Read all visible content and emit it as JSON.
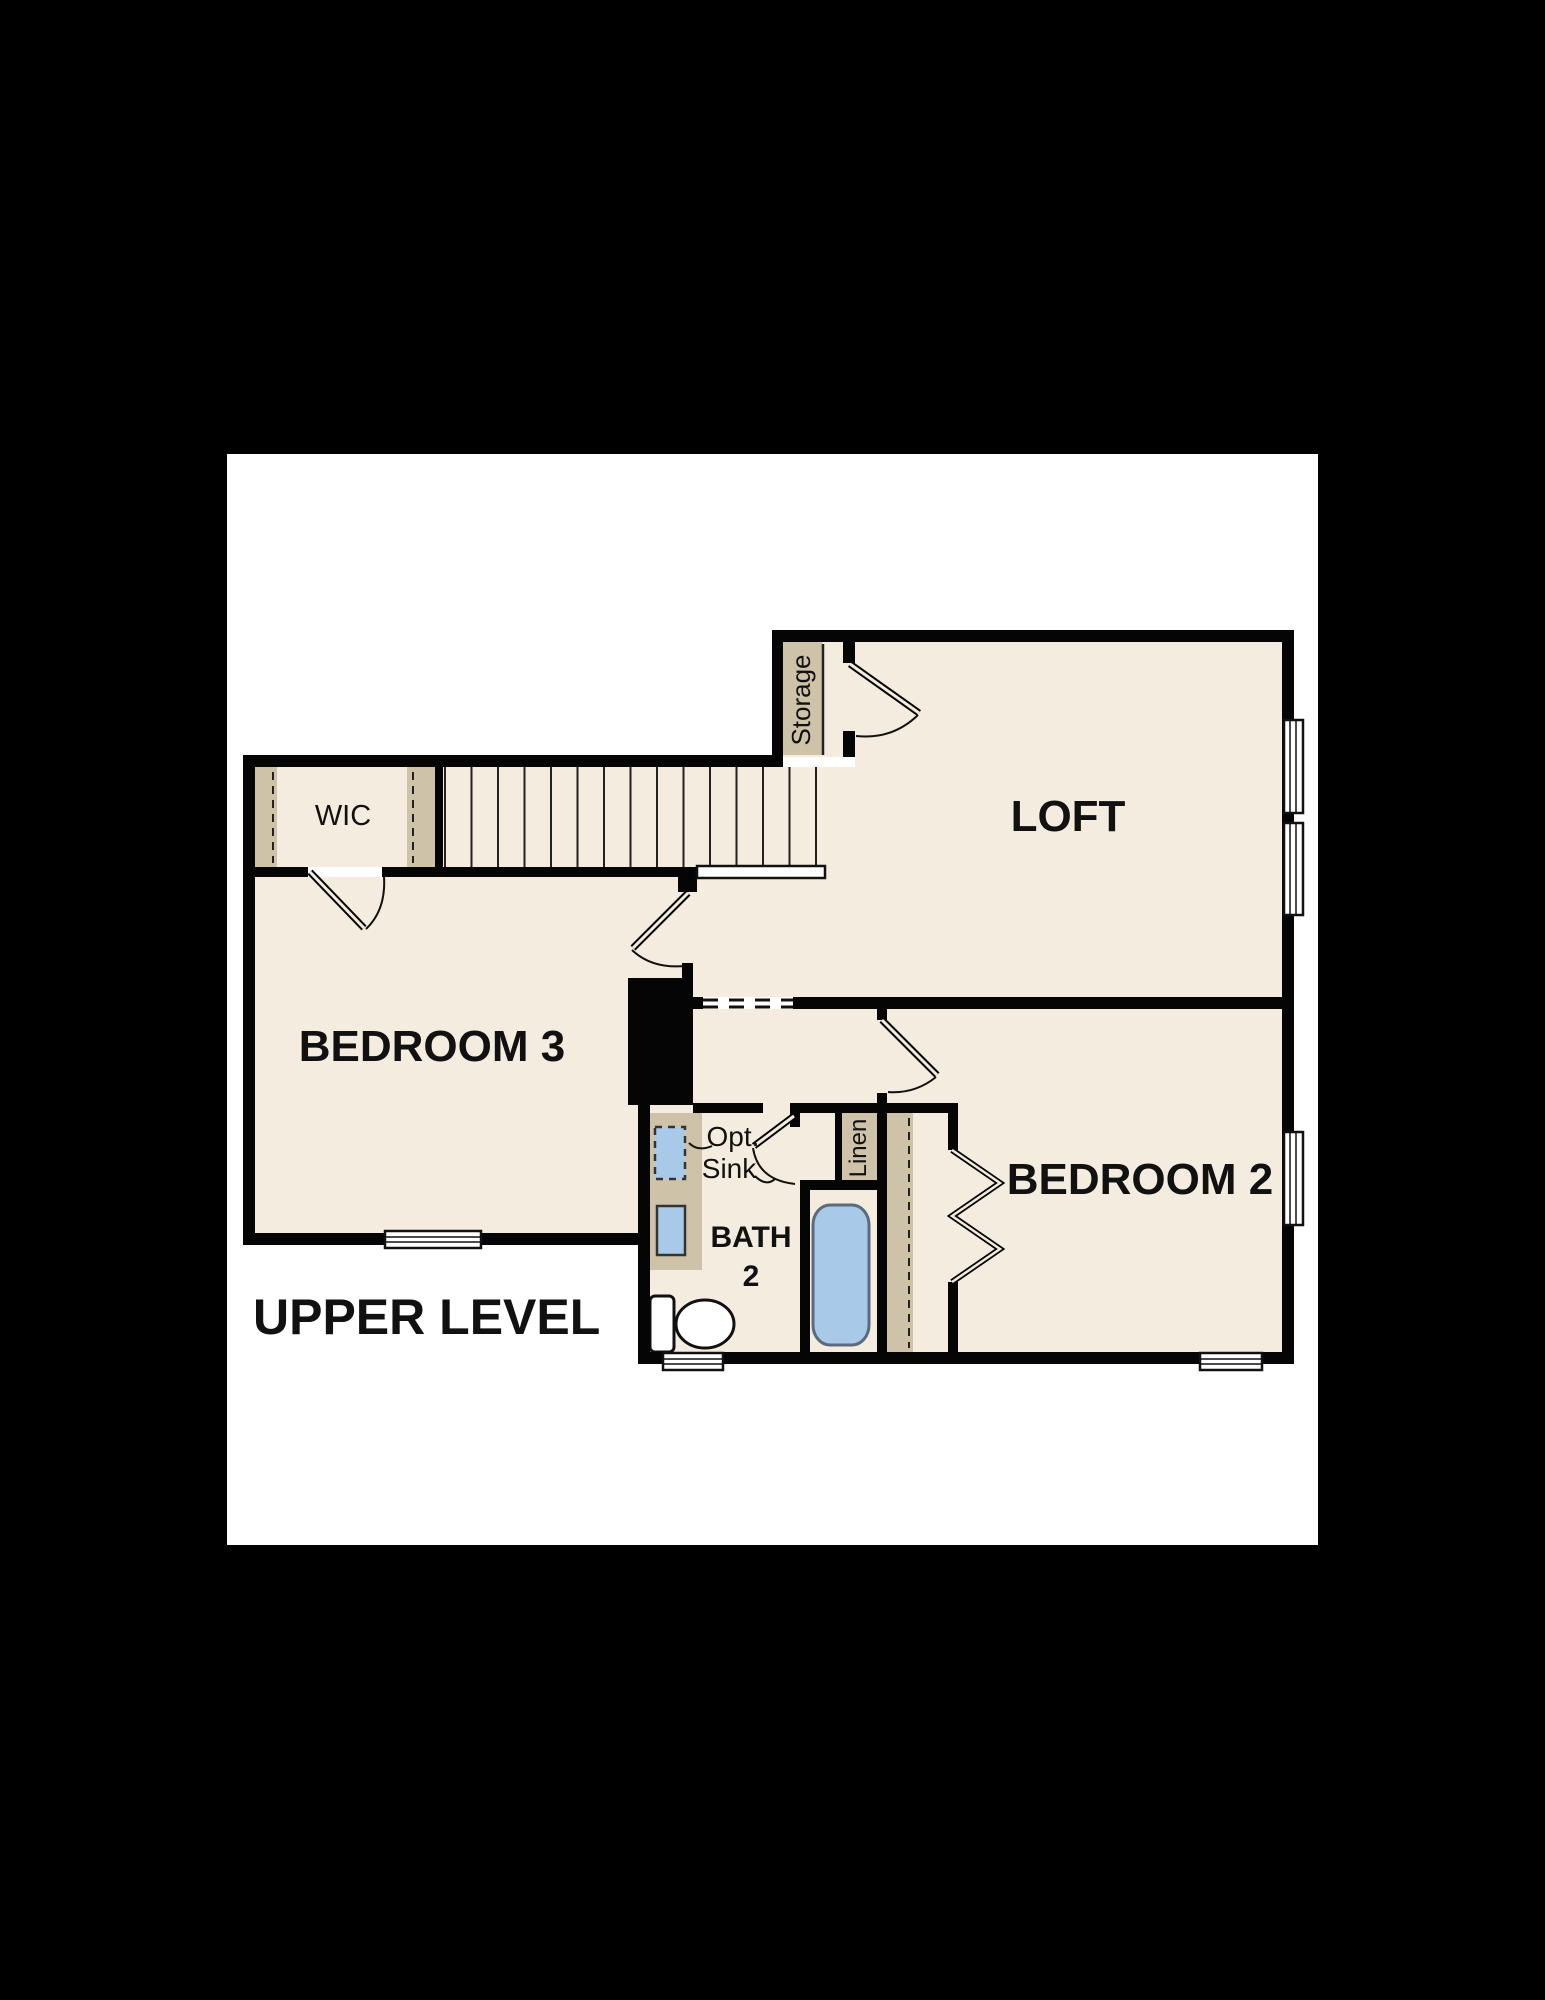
{
  "title": "UPPER LEVEL",
  "labels": {
    "loft": "LOFT",
    "bedroom3": "BEDROOM 3",
    "bedroom2": "BEDROOM 2",
    "bath_line1": "BATH",
    "bath_line2": "2",
    "wic": "WIC",
    "storage": "Storage",
    "linen": "Linen",
    "opt_sink_line1": "Opt.",
    "opt_sink_line2": "Sink"
  },
  "colors": {
    "background": "#000000",
    "paper": "#ffffff",
    "floor": "#f4ecdf",
    "wall": "#050505",
    "casework_tan": "#cec2a8",
    "fixture_blue": "#a9c9e9",
    "text": "#111111"
  }
}
